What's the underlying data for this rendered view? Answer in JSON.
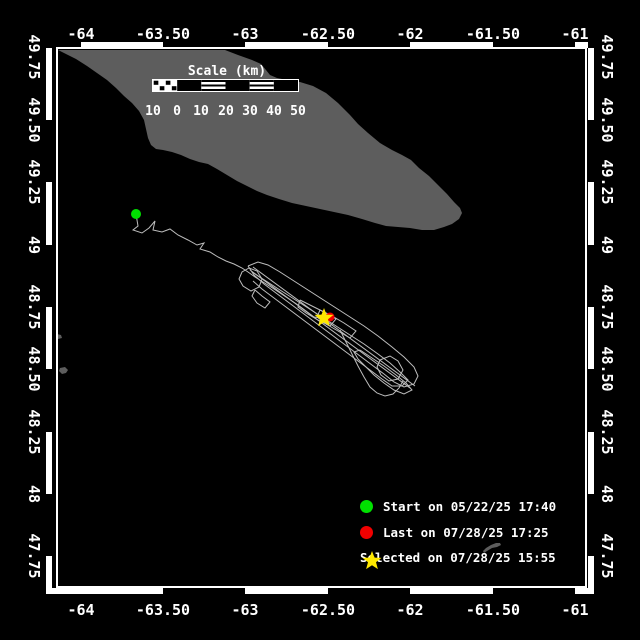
{
  "frame": {
    "border": {
      "x": 57,
      "y": 48,
      "w": 529,
      "h": 539
    },
    "band_thickness": 6,
    "outer": {
      "x0": 46,
      "y0": 42,
      "x1": 594,
      "y1": 594
    },
    "zebra_black_x_top": [
      [
        46,
        81
      ],
      [
        163,
        245
      ],
      [
        328,
        410
      ],
      [
        493,
        575
      ],
      [
        588,
        594
      ]
    ],
    "zebra_black_x_bottom": [
      [
        163,
        245
      ],
      [
        328,
        410
      ],
      [
        493,
        575
      ]
    ],
    "zebra_black_y": [
      [
        120,
        182
      ],
      [
        245,
        307
      ],
      [
        369,
        432
      ],
      [
        494,
        556
      ]
    ]
  },
  "axes": {
    "x_ticks": [
      {
        "label": "-64",
        "x": 81
      },
      {
        "label": "-63.50",
        "x": 163
      },
      {
        "label": "-63",
        "x": 245
      },
      {
        "label": "-62.50",
        "x": 328
      },
      {
        "label": "-62",
        "x": 410
      },
      {
        "label": "-61.50",
        "x": 493
      },
      {
        "label": "-61",
        "x": 575
      }
    ],
    "y_ticks": [
      {
        "label": "49.75",
        "y": 57
      },
      {
        "label": "49.50",
        "y": 120
      },
      {
        "label": "49.25",
        "y": 182
      },
      {
        "label": "49",
        "y": 245
      },
      {
        "label": "48.75",
        "y": 307
      },
      {
        "label": "48.50",
        "y": 369
      },
      {
        "label": "48.25",
        "y": 432
      },
      {
        "label": "48",
        "y": 494
      },
      {
        "label": "47.75",
        "y": 556
      }
    ],
    "top_label_y": 25,
    "bottom_label_y": 601,
    "left_label_x": 34,
    "right_label_x": 607
  },
  "scale_bar": {
    "title": "Scale (km)",
    "title_cx": 227,
    "title_cy": 64,
    "bar": {
      "x": 153,
      "y": 80,
      "w": 145,
      "h": 11
    },
    "segments": [
      "checker",
      "solid",
      "striped",
      "solid",
      "striped",
      "solid"
    ],
    "labels": [
      "10",
      "0",
      "10",
      "20",
      "30",
      "40",
      "50"
    ],
    "label_xs": [
      153,
      177,
      201,
      226,
      250,
      274,
      298
    ],
    "label_y": 104
  },
  "land": {
    "color": "#5d5d5d",
    "island": [
      [
        58,
        50
      ],
      [
        225,
        50
      ],
      [
        238,
        55
      ],
      [
        252,
        60
      ],
      [
        261,
        64
      ],
      [
        266,
        70
      ],
      [
        270,
        75
      ],
      [
        277,
        78
      ],
      [
        287,
        80
      ],
      [
        300,
        82
      ],
      [
        313,
        86
      ],
      [
        326,
        93
      ],
      [
        338,
        103
      ],
      [
        350,
        115
      ],
      [
        358,
        124
      ],
      [
        368,
        133
      ],
      [
        380,
        143
      ],
      [
        392,
        150
      ],
      [
        402,
        155
      ],
      [
        411,
        160
      ],
      [
        419,
        168
      ],
      [
        429,
        176
      ],
      [
        439,
        186
      ],
      [
        447,
        194
      ],
      [
        454,
        202
      ],
      [
        460,
        208
      ],
      [
        462,
        213
      ],
      [
        459,
        219
      ],
      [
        452,
        224
      ],
      [
        444,
        227
      ],
      [
        434,
        230
      ],
      [
        422,
        230
      ],
      [
        410,
        228
      ],
      [
        398,
        227
      ],
      [
        386,
        226
      ],
      [
        375,
        223
      ],
      [
        362,
        219
      ],
      [
        348,
        215
      ],
      [
        334,
        212
      ],
      [
        320,
        209
      ],
      [
        306,
        206
      ],
      [
        292,
        203
      ],
      [
        279,
        199
      ],
      [
        267,
        195
      ],
      [
        257,
        191
      ],
      [
        247,
        186
      ],
      [
        237,
        181
      ],
      [
        227,
        175
      ],
      [
        217,
        169
      ],
      [
        208,
        164
      ],
      [
        199,
        162
      ],
      [
        190,
        159
      ],
      [
        181,
        155
      ],
      [
        172,
        152
      ],
      [
        163,
        150
      ],
      [
        156,
        149
      ],
      [
        151,
        145
      ],
      [
        148,
        138
      ],
      [
        146,
        129
      ],
      [
        144,
        120
      ],
      [
        139,
        111
      ],
      [
        132,
        103
      ],
      [
        124,
        96
      ],
      [
        116,
        88
      ],
      [
        107,
        80
      ],
      [
        97,
        73
      ],
      [
        87,
        66
      ],
      [
        76,
        59
      ],
      [
        66,
        54
      ]
    ],
    "islets": [
      [
        [
          60,
          368
        ],
        [
          65,
          367
        ],
        [
          68,
          370
        ],
        [
          66,
          373
        ],
        [
          62,
          374
        ],
        [
          59,
          371
        ]
      ],
      [
        [
          57,
          334
        ],
        [
          61,
          335
        ],
        [
          62,
          338
        ],
        [
          58,
          339
        ],
        [
          56,
          337
        ]
      ],
      [
        [
          483,
          551
        ],
        [
          486,
          548
        ],
        [
          491,
          545
        ],
        [
          496,
          543
        ],
        [
          500,
          543
        ],
        [
          501,
          545
        ],
        [
          497,
          547
        ],
        [
          492,
          548
        ],
        [
          487,
          551
        ],
        [
          484,
          553
        ]
      ]
    ]
  },
  "track": {
    "color": "#bdbdbd",
    "polylines": [
      [
        [
          136,
          214
        ],
        [
          138,
          226
        ],
        [
          133,
          230
        ],
        [
          142,
          233
        ],
        [
          149,
          228
        ],
        [
          155,
          221
        ],
        [
          153,
          230
        ],
        [
          162,
          232
        ],
        [
          170,
          229
        ],
        [
          178,
          235
        ],
        [
          188,
          240
        ],
        [
          197,
          245
        ],
        [
          204,
          243
        ],
        [
          200,
          249
        ],
        [
          210,
          252
        ],
        [
          218,
          257
        ],
        [
          226,
          261
        ],
        [
          234,
          264
        ],
        [
          242,
          268
        ],
        [
          248,
          272
        ],
        [
          255,
          277
        ],
        [
          263,
          282
        ],
        [
          271,
          287
        ],
        [
          280,
          293
        ],
        [
          289,
          299
        ],
        [
          298,
          305
        ],
        [
          306,
          311
        ],
        [
          314,
          317
        ],
        [
          322,
          318
        ]
      ],
      [
        [
          248,
          266
        ],
        [
          258,
          262
        ],
        [
          268,
          265
        ],
        [
          280,
          272
        ],
        [
          294,
          281
        ],
        [
          308,
          290
        ],
        [
          322,
          299
        ],
        [
          336,
          308
        ],
        [
          350,
          317
        ],
        [
          364,
          326
        ],
        [
          378,
          336
        ],
        [
          392,
          347
        ],
        [
          404,
          357
        ],
        [
          414,
          367
        ],
        [
          418,
          376
        ],
        [
          414,
          384
        ],
        [
          404,
          387
        ],
        [
          394,
          382
        ],
        [
          384,
          374
        ],
        [
          372,
          365
        ],
        [
          360,
          356
        ],
        [
          348,
          347
        ],
        [
          336,
          338
        ],
        [
          324,
          329
        ],
        [
          312,
          320
        ],
        [
          300,
          311
        ],
        [
          288,
          302
        ],
        [
          276,
          293
        ],
        [
          264,
          284
        ],
        [
          254,
          275
        ],
        [
          248,
          266
        ]
      ],
      [
        [
          252,
          272
        ],
        [
          266,
          281
        ],
        [
          280,
          290
        ],
        [
          294,
          299
        ],
        [
          308,
          308
        ],
        [
          322,
          317
        ],
        [
          336,
          326
        ],
        [
          350,
          335
        ],
        [
          364,
          344
        ],
        [
          378,
          354
        ],
        [
          390,
          363
        ],
        [
          400,
          372
        ],
        [
          408,
          380
        ],
        [
          402,
          386
        ],
        [
          392,
          386
        ],
        [
          382,
          379
        ],
        [
          370,
          370
        ],
        [
          358,
          361
        ],
        [
          346,
          352
        ],
        [
          334,
          343
        ],
        [
          322,
          334
        ],
        [
          310,
          325
        ],
        [
          298,
          316
        ],
        [
          286,
          307
        ],
        [
          274,
          298
        ],
        [
          262,
          289
        ],
        [
          253,
          281
        ]
      ],
      [
        [
          249,
          268
        ],
        [
          242,
          272
        ],
        [
          239,
          279
        ],
        [
          243,
          286
        ],
        [
          251,
          291
        ],
        [
          259,
          287
        ],
        [
          262,
          279
        ],
        [
          257,
          271
        ],
        [
          249,
          268
        ]
      ],
      [
        [
          255,
          290
        ],
        [
          262,
          296
        ],
        [
          270,
          302
        ],
        [
          265,
          308
        ],
        [
          257,
          303
        ],
        [
          252,
          296
        ],
        [
          255,
          290
        ]
      ],
      [
        [
          253,
          267
        ],
        [
          415,
          386
        ]
      ],
      [
        [
          250,
          270
        ],
        [
          410,
          388
        ]
      ],
      [
        [
          300,
          300
        ],
        [
          312,
          306
        ],
        [
          324,
          312
        ],
        [
          336,
          319
        ],
        [
          330,
          326
        ],
        [
          318,
          320
        ],
        [
          306,
          313
        ],
        [
          298,
          307
        ],
        [
          300,
          300
        ]
      ],
      [
        [
          320,
          310
        ],
        [
          332,
          316
        ],
        [
          344,
          323
        ],
        [
          356,
          331
        ],
        [
          350,
          338
        ],
        [
          338,
          331
        ],
        [
          326,
          324
        ],
        [
          317,
          317
        ],
        [
          320,
          310
        ]
      ],
      [
        [
          360,
          350
        ],
        [
          372,
          358
        ],
        [
          384,
          366
        ],
        [
          396,
          375
        ],
        [
          406,
          383
        ],
        [
          412,
          390
        ],
        [
          404,
          394
        ],
        [
          394,
          390
        ],
        [
          384,
          383
        ],
        [
          374,
          375
        ],
        [
          366,
          367
        ],
        [
          358,
          359
        ],
        [
          354,
          352
        ],
        [
          360,
          350
        ]
      ],
      [
        [
          380,
          360
        ],
        [
          390,
          356
        ],
        [
          398,
          361
        ],
        [
          403,
          370
        ],
        [
          398,
          379
        ],
        [
          389,
          381
        ],
        [
          381,
          375
        ],
        [
          377,
          367
        ],
        [
          380,
          360
        ]
      ],
      [
        [
          340,
          330
        ],
        [
          346,
          342
        ],
        [
          352,
          354
        ],
        [
          358,
          366
        ],
        [
          364,
          377
        ],
        [
          370,
          387
        ],
        [
          377,
          393
        ],
        [
          385,
          396
        ],
        [
          393,
          394
        ],
        [
          399,
          388
        ],
        [
          403,
          381
        ]
      ]
    ]
  },
  "markers": {
    "start": {
      "x": 136,
      "y": 214,
      "r": 5,
      "color": "#00e100"
    },
    "last": {
      "x": 330,
      "y": 317,
      "r": 4.5,
      "color": "#f10000"
    },
    "selected": {
      "x": 324,
      "y": 318,
      "r": 10,
      "color": "#ffe900"
    }
  },
  "legend": {
    "rows_y": [
      499,
      525,
      550
    ],
    "marker_x": 360,
    "items": [
      {
        "marker": "circle",
        "color": "#00e100",
        "label": "Start on 05/22/25 17:40"
      },
      {
        "marker": "circle",
        "color": "#f10000",
        "label": "Last on 07/28/25 17:25"
      },
      {
        "marker": "star",
        "color": "#ffe900",
        "label": "Selected on 07/28/25 15:55"
      }
    ]
  }
}
